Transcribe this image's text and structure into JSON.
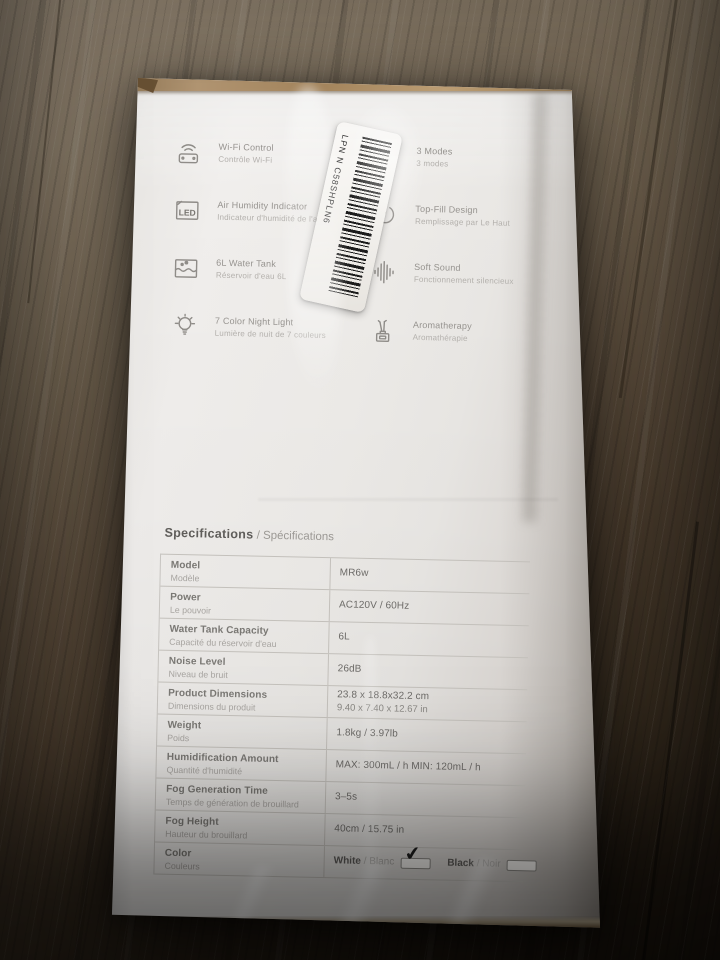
{
  "sticker": {
    "lpn": "LPN N C58SHPLN6"
  },
  "icons": {
    "led_label": "LED"
  },
  "features": {
    "left": [
      {
        "icon": "wifi-remote-icon",
        "en": "Wi-Fi Control",
        "fr": "Contrôle Wi-Fi"
      },
      {
        "icon": "led-indicator-icon",
        "en": "Air Humidity Indicator",
        "fr": "Indicateur d'humidité de l'air"
      },
      {
        "icon": "water-tank-icon",
        "en": "6L Water Tank",
        "fr": "Réservoir d'eau 6L"
      },
      {
        "icon": "night-light-icon",
        "en": "7 Color Night Light",
        "fr": "Lumière de nuit de 7 couleurs"
      }
    ],
    "right": [
      {
        "icon": "steam-modes-icon",
        "en": "3 Modes",
        "fr": "3 modes"
      },
      {
        "icon": "top-fill-icon",
        "en": "Top-Fill Design",
        "fr": "Remplissage par Le Haut"
      },
      {
        "icon": "soft-sound-icon",
        "en": "Soft Sound",
        "fr": "Fonctionnement silencieux"
      },
      {
        "icon": "aromatherapy-icon",
        "en": "Aromatherapy",
        "fr": "Aromathérapie"
      }
    ]
  },
  "specs": {
    "title_en": "Specifications",
    "title_sep": " / ",
    "title_fr": "Spécifications",
    "check_glyph": "✔",
    "rows": [
      {
        "label_en": "Model",
        "label_fr": "Modèle",
        "value": "MR6w"
      },
      {
        "label_en": "Power",
        "label_fr": "Le pouvoir",
        "value": "AC120V / 60Hz"
      },
      {
        "label_en": "Water Tank Capacity",
        "label_fr": "Capacité du réservoir d'eau",
        "value": "6L"
      },
      {
        "label_en": "Noise Level",
        "label_fr": "Niveau de bruit",
        "value": "26dB"
      },
      {
        "label_en": "Product Dimensions",
        "label_fr": "Dimensions du produit",
        "value": "23.8 x 18.8x32.2 cm",
        "value2": "9.40 x 7.40 x 12.67 in"
      },
      {
        "label_en": "Weight",
        "label_fr": "Poids",
        "value": "1.8kg / 3.97lb"
      },
      {
        "label_en": "Humidification Amount",
        "label_fr": "Quantité d'humidité",
        "value": "MAX: 300mL / h MIN: 120mL / h"
      },
      {
        "label_en": "Fog Generation Time",
        "label_fr": "Temps de génération de brouillard",
        "value": "3–5s"
      },
      {
        "label_en": "Fog Height",
        "label_fr": "Hauteur du brouillard",
        "value": "40cm / 15.75 in"
      },
      {
        "label_en": "Color",
        "label_fr": "Couleurs",
        "options": [
          {
            "en": "White",
            "sep": " / ",
            "fr": "Blanc",
            "checked": true
          },
          {
            "en": "Black",
            "sep": " / ",
            "fr": "Noir",
            "checked": false
          }
        ]
      }
    ]
  },
  "colors": {
    "floor_light": "#8e8170",
    "floor_dark": "#1a140d",
    "box_face": "#edebe8",
    "lid_tan": "#a8885f",
    "print_gray": "#96938f",
    "table_line": "#c3c0bb",
    "check_black": "#1f1f1f"
  }
}
